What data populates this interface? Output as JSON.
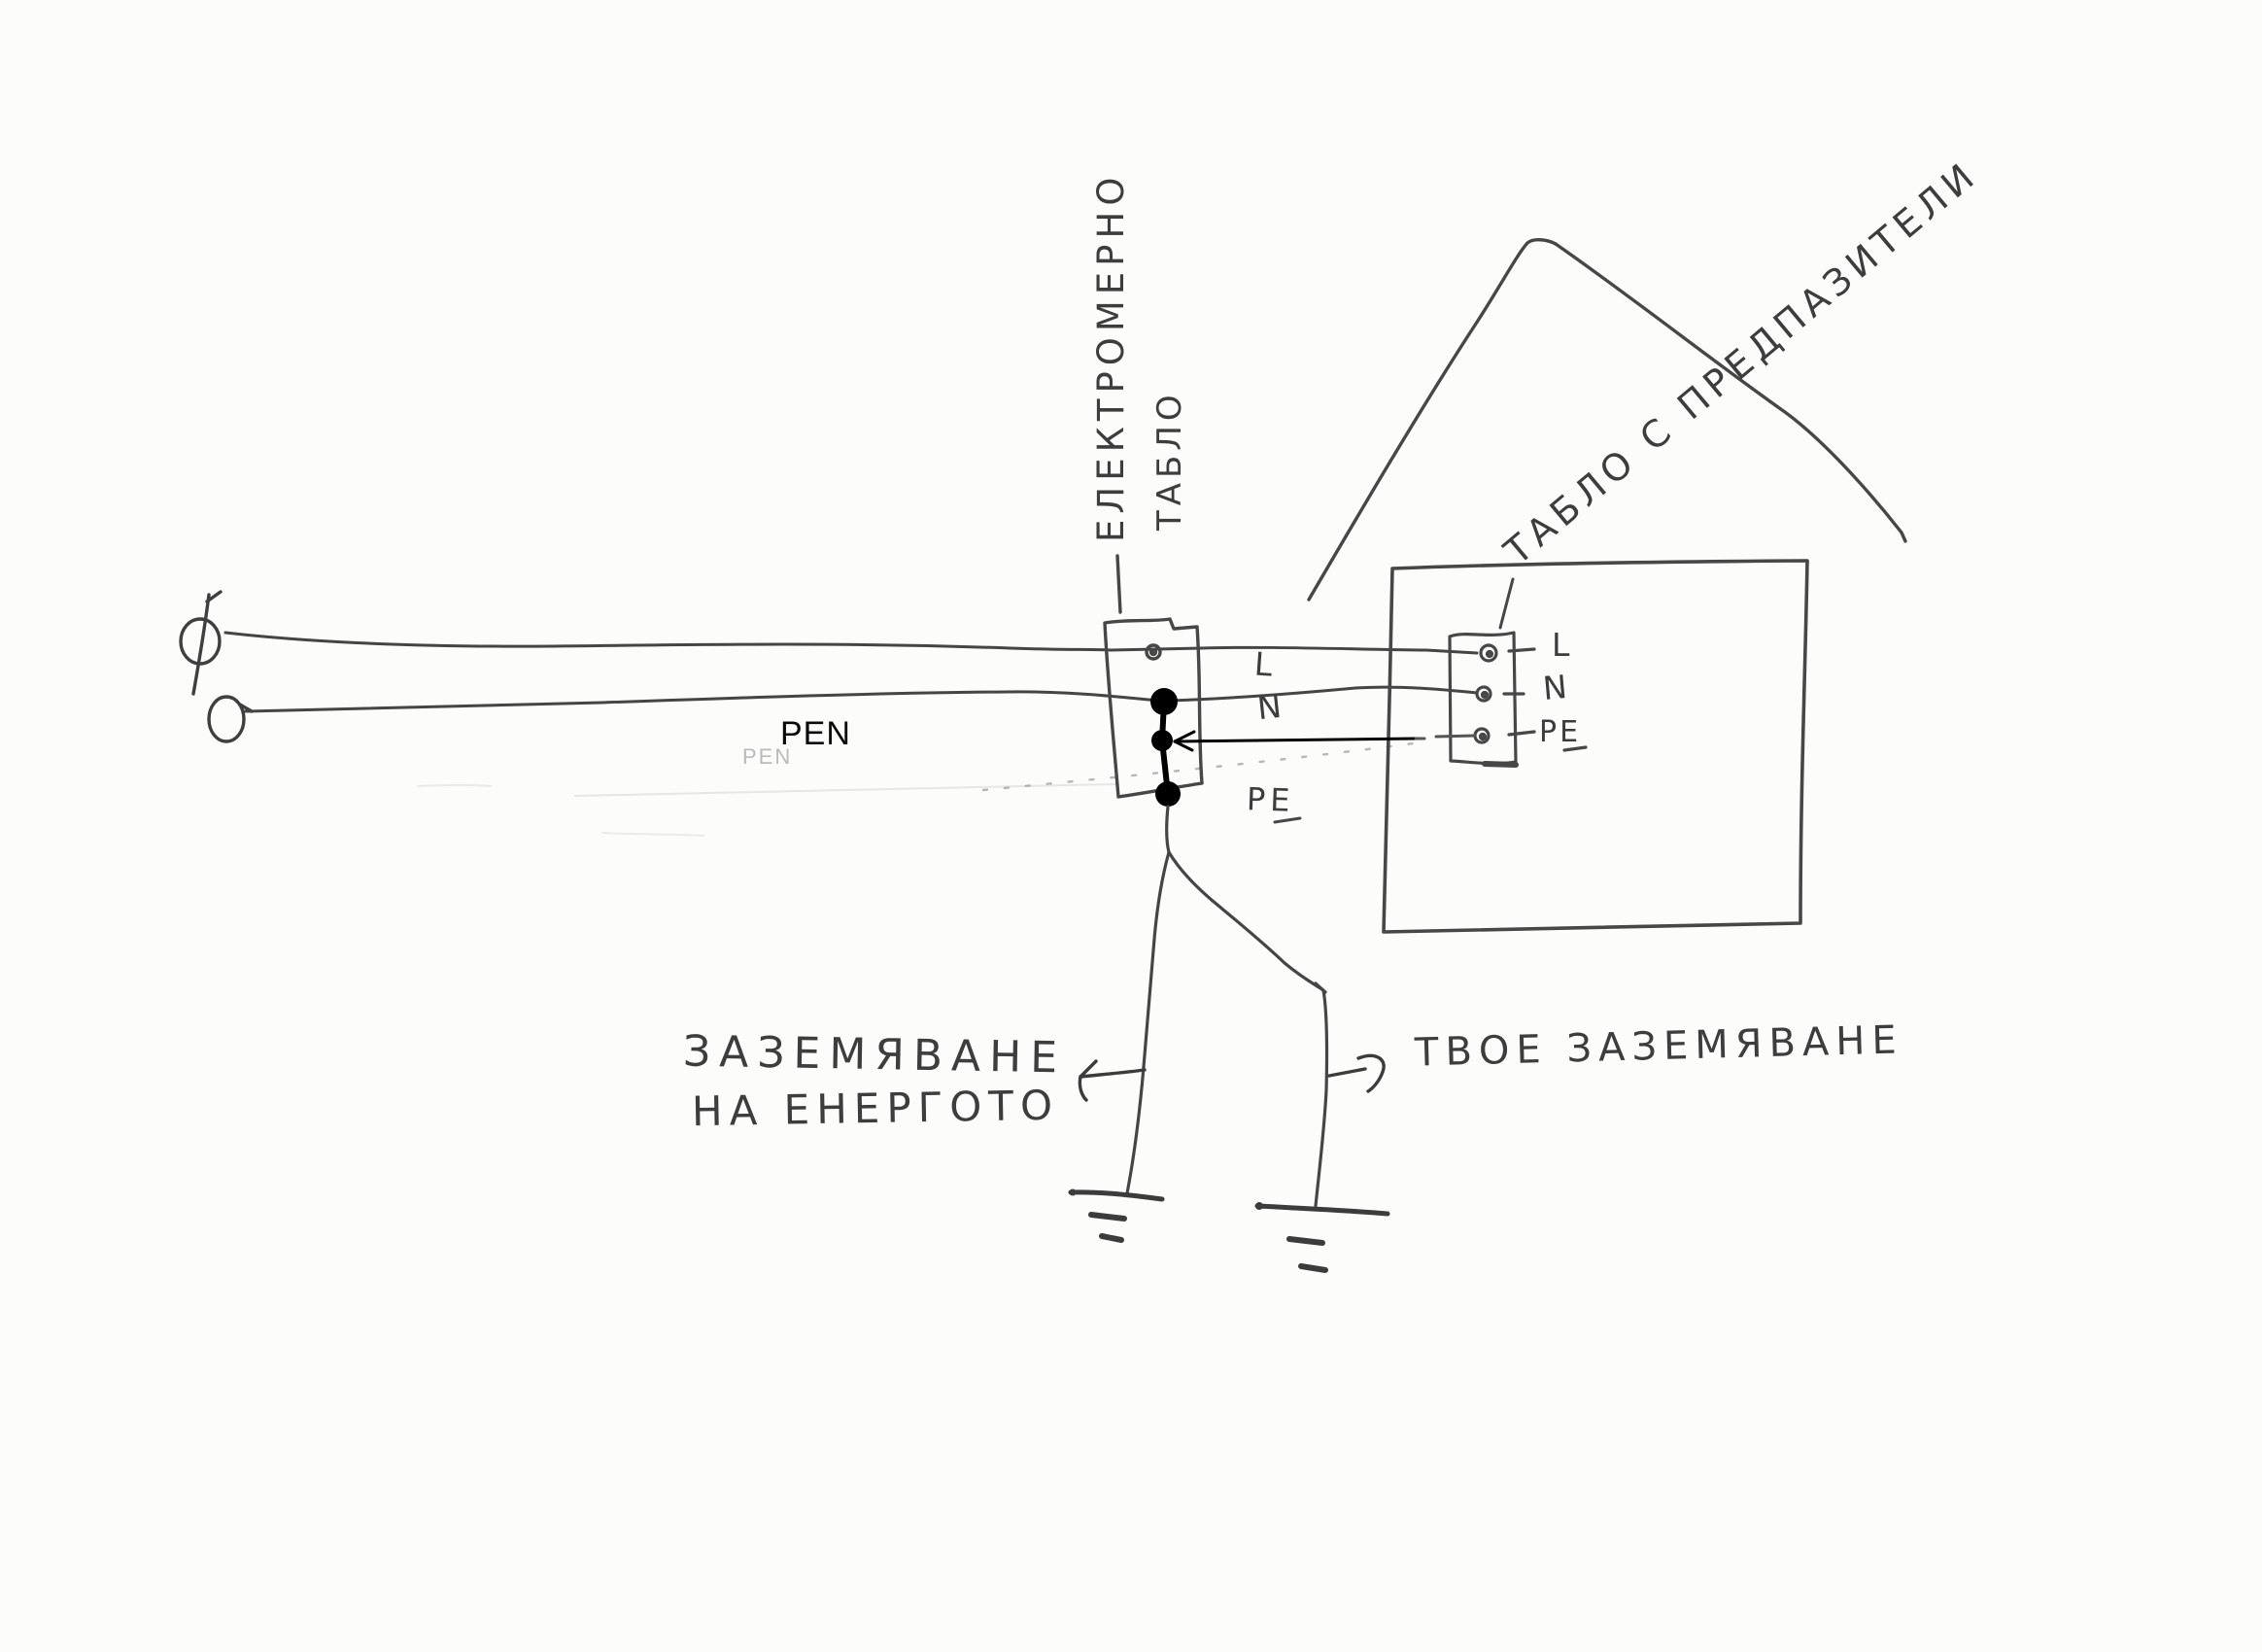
{
  "drawing": {
    "kind": "hand-drawn electrical wiring sketch",
    "language": "Bulgarian"
  },
  "labels": {
    "meter_board_line1": "ЕЛЕКТРОМЕРНО",
    "meter_board_line2": "ТАБЛО",
    "fuse_board_title": "ТАБЛО С ПРЕДПАЗИТЕЛИ",
    "pen": "PEN",
    "pen_ghost": "PEN",
    "mid": {
      "l": "L",
      "n": "N",
      "pe": "PE"
    },
    "fuse_terminals": {
      "l": "L",
      "n": "N",
      "pe": "PE"
    },
    "grounding_left_line1": "ЗАЗЕМЯВАНЕ",
    "grounding_left_line2": "НА ЕНЕРГОТО",
    "grounding_right": "ТВОЕ ЗАЗЕМЯВАНЕ"
  },
  "icons": {
    "phase_source": "circle-with-slash (Φ phase symbol)",
    "neutral_source": "circle (O neutral symbol)",
    "earth_left": "earth-ground bars",
    "earth_right": "earth-ground bars",
    "junction_dots": "3 solid black junction dots",
    "pe_arrow": "straight arrow from PE terminal to junction",
    "left_pointer_arrow": "arrow pointing left to grounding text",
    "right_pointer_arrow": "arrow pointing right to grounding text"
  },
  "colors": {
    "paper": "#fcfcfb",
    "pencil": "#454545",
    "ink_overlay": "#000000",
    "faded_pencil": "#9a9a9a"
  }
}
